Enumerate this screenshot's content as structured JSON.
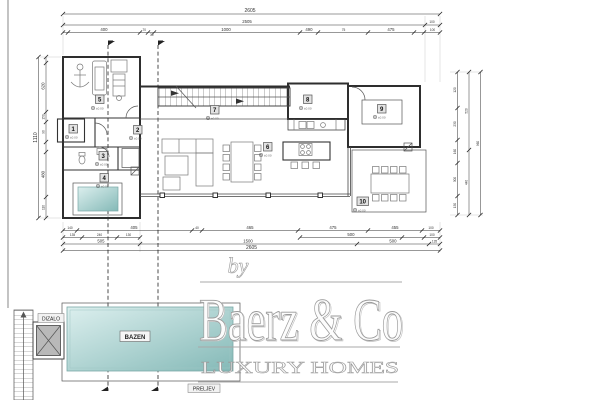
{
  "watermark": {
    "by": "by",
    "brand": "Baerz & Co",
    "tagline": "LUXURY HOMES"
  },
  "pool": {
    "label": "BAZEN",
    "elevator": "DIZALO",
    "overflow": "PRELJEV"
  },
  "rooms": {
    "r1": "1",
    "r2": "2",
    "r3": "3",
    "r4": "4",
    "r5": "5",
    "r6": "6",
    "r7": "7",
    "r8": "8",
    "r9": "9",
    "r10": "10"
  },
  "elevation_mark": "±0.00",
  "dims": {
    "top_total": "2605",
    "top_total2": "2505",
    "top_right": "100",
    "top_chain": [
      "400",
      "70",
      "30",
      "1000",
      "490",
      "75",
      "475",
      "100"
    ],
    "bottom_a": [
      "140",
      "405",
      "40",
      "465",
      "475",
      "455",
      "100"
    ],
    "bottom_b": [
      "135",
      "240",
      "130",
      "500",
      "100"
    ],
    "bottom_c": [
      "505",
      "1500",
      "500",
      "135"
    ],
    "bottom_total": "2605",
    "left_total": "1110",
    "left_chain": [
      "620",
      "150",
      "90",
      "480",
      "110"
    ],
    "right_chain1": [
      "120",
      "230",
      "160",
      "300",
      "150"
    ],
    "right_chain2": [
      "520",
      "440"
    ],
    "right_chain3": [
      "960"
    ]
  },
  "colors": {
    "pool_light": "#dcefee",
    "pool_dark": "#84b9b7",
    "wall_line": "#2e2e2e",
    "dim_line": "#333333",
    "watermark_stroke": "#9a9a9a"
  }
}
